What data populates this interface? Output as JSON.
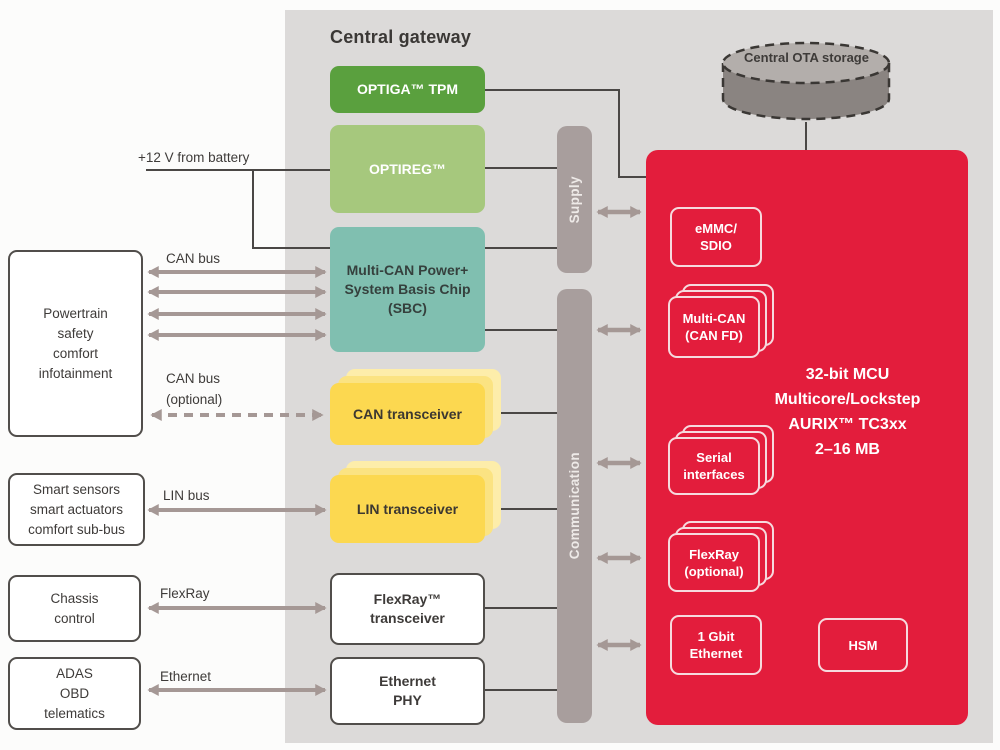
{
  "title": "Central gateway",
  "storage": {
    "label": "Central OTA storage"
  },
  "bus_labels": {
    "battery": "+12 V from battery",
    "can": "CAN bus",
    "can_opt_1": "CAN bus",
    "can_opt_2": "(optional)",
    "lin": "LIN bus",
    "flexray": "FlexRay",
    "ethernet": "Ethernet"
  },
  "left_nodes": [
    {
      "id": "powertrain",
      "lines": [
        "Powertrain",
        "safety",
        "comfort",
        "infotainment"
      ]
    },
    {
      "id": "smart",
      "lines": [
        "Smart sensors",
        "smart actuators",
        "comfort sub-bus"
      ]
    },
    {
      "id": "chassis",
      "lines": [
        "Chassis",
        "control"
      ]
    },
    {
      "id": "adas",
      "lines": [
        "ADAS",
        "OBD",
        "telematics"
      ]
    }
  ],
  "gateway": {
    "optiga": "OPTIGA™ TPM",
    "optireg": "OPTIREG™",
    "sbc_lines": [
      "Multi-CAN Power+",
      "System Basis Chip",
      "(SBC)"
    ],
    "can_transceiver": "CAN transceiver",
    "lin_transceiver": "LIN transceiver",
    "flexray_transceiver_lines": [
      "FlexRay™",
      "transceiver"
    ],
    "ethernet_phy_lines": [
      "Ethernet",
      "PHY"
    ]
  },
  "bars": {
    "supply": "Supply",
    "communication": "Communication"
  },
  "mcu": {
    "title_lines": [
      "32-bit MCU",
      "Multicore/Lockstep",
      "AURIX™ TC3xx",
      "2–16 MB"
    ],
    "emmc_lines": [
      "eMMC/",
      "SDIO"
    ],
    "multican_lines": [
      "Multi-CAN",
      "(CAN FD)"
    ],
    "serial_lines": [
      "Serial",
      "interfaces"
    ],
    "flexray_lines": [
      "FlexRay",
      "(optional)"
    ],
    "gbit_lines": [
      "1 Gbit",
      "Ethernet"
    ],
    "hsm": "HSM"
  },
  "colors": {
    "panel_bg": "#dcdad9",
    "red": "#e31d3c",
    "green_dark": "#5aa03e",
    "green_light": "#a6c87d",
    "teal": "#80bfb0",
    "yellow": "#fcd850",
    "yellow_mid": "#fbe382",
    "yellow_light": "#fdedaa",
    "bar_gray": "#a89e9d",
    "arrow_gray": "#a59895",
    "wire_dark": "#4a4745",
    "cylinder_top": "#b3aeab",
    "cylinder_body": "#8a8481",
    "text_dark": "#3e3b39"
  }
}
